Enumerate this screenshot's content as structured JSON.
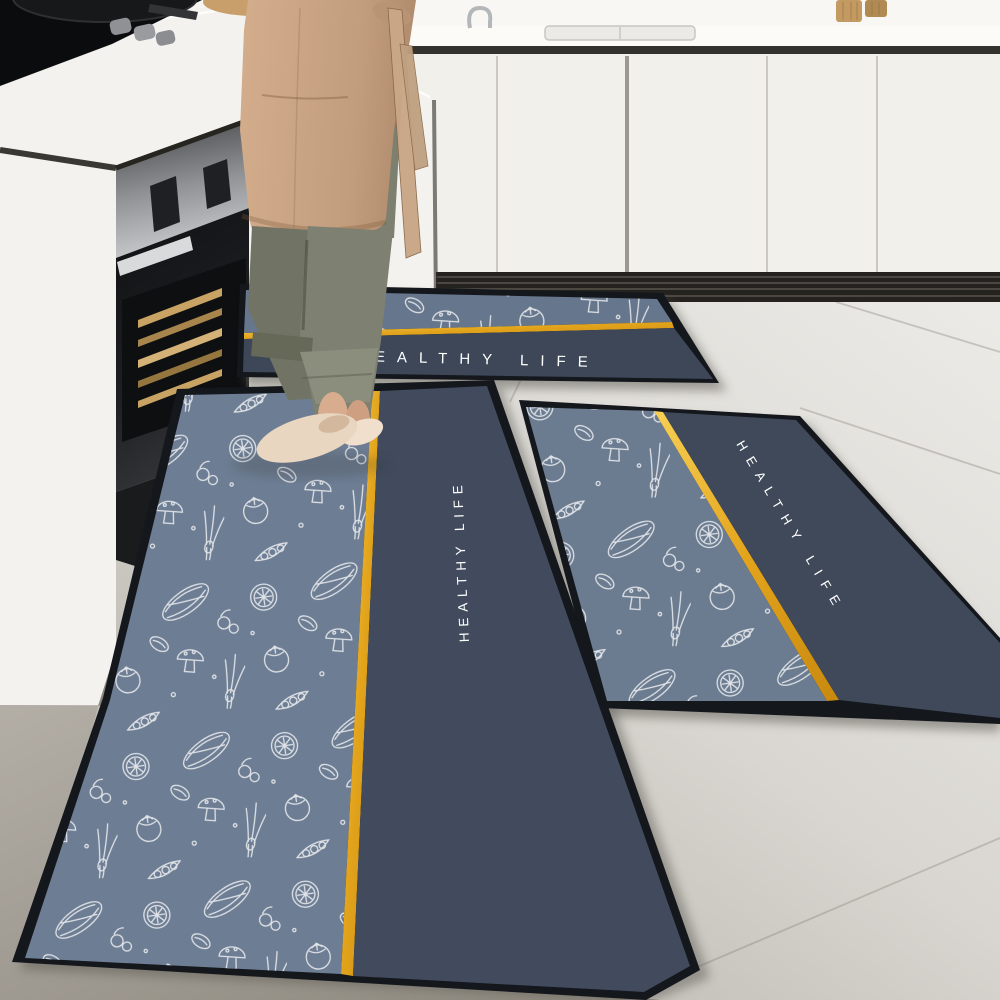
{
  "image": {
    "kind": "product lifestyle photo",
    "subject": "3-piece anti-slip kitchen floor mat set with white hand-sketched vegetable print, gold stripe and HEALTHY LIFE lettering",
    "setting": "modern white kitchen; black gas cooktop and built-in oven with open drawer of wooden trays on the left; person in beige apron, olive trousers and beige slippers standing on the runner mat; light grey tiled floor"
  },
  "mats": {
    "print_text": "HEALTHY LIFE",
    "back_mat": {
      "text": "HEALTHY LIFE",
      "note": "horizontal mat along rear cabinets, first letter hidden behind leg"
    },
    "runner_mat": {
      "text": "HEALTHY LIFE",
      "note": "long runner, lettering reads bottom-to-top"
    },
    "side_mat": {
      "text": "HEALTHY LIFE",
      "note": "angled mat at right, lettering runs diagonally"
    },
    "colors": {
      "pattern_panel": "#6d7d93",
      "text_band": "#3f4a5c",
      "gold_stripe": "#e8a81f",
      "edge_border": "#14171c",
      "print": "#ffffff"
    }
  },
  "palette": {
    "floor_tile": "#d7d4cf",
    "cabinets": "#f2f0ea",
    "countertop": "#fbfaf7",
    "kickboard": "#24231f",
    "stainless": "#8b8d90",
    "cooktop": "#0b0c0e",
    "apron": "#c6a283",
    "trousers": "#7e8171",
    "slippers": "#e8d5c0",
    "wood_trays": "#c8a363"
  }
}
